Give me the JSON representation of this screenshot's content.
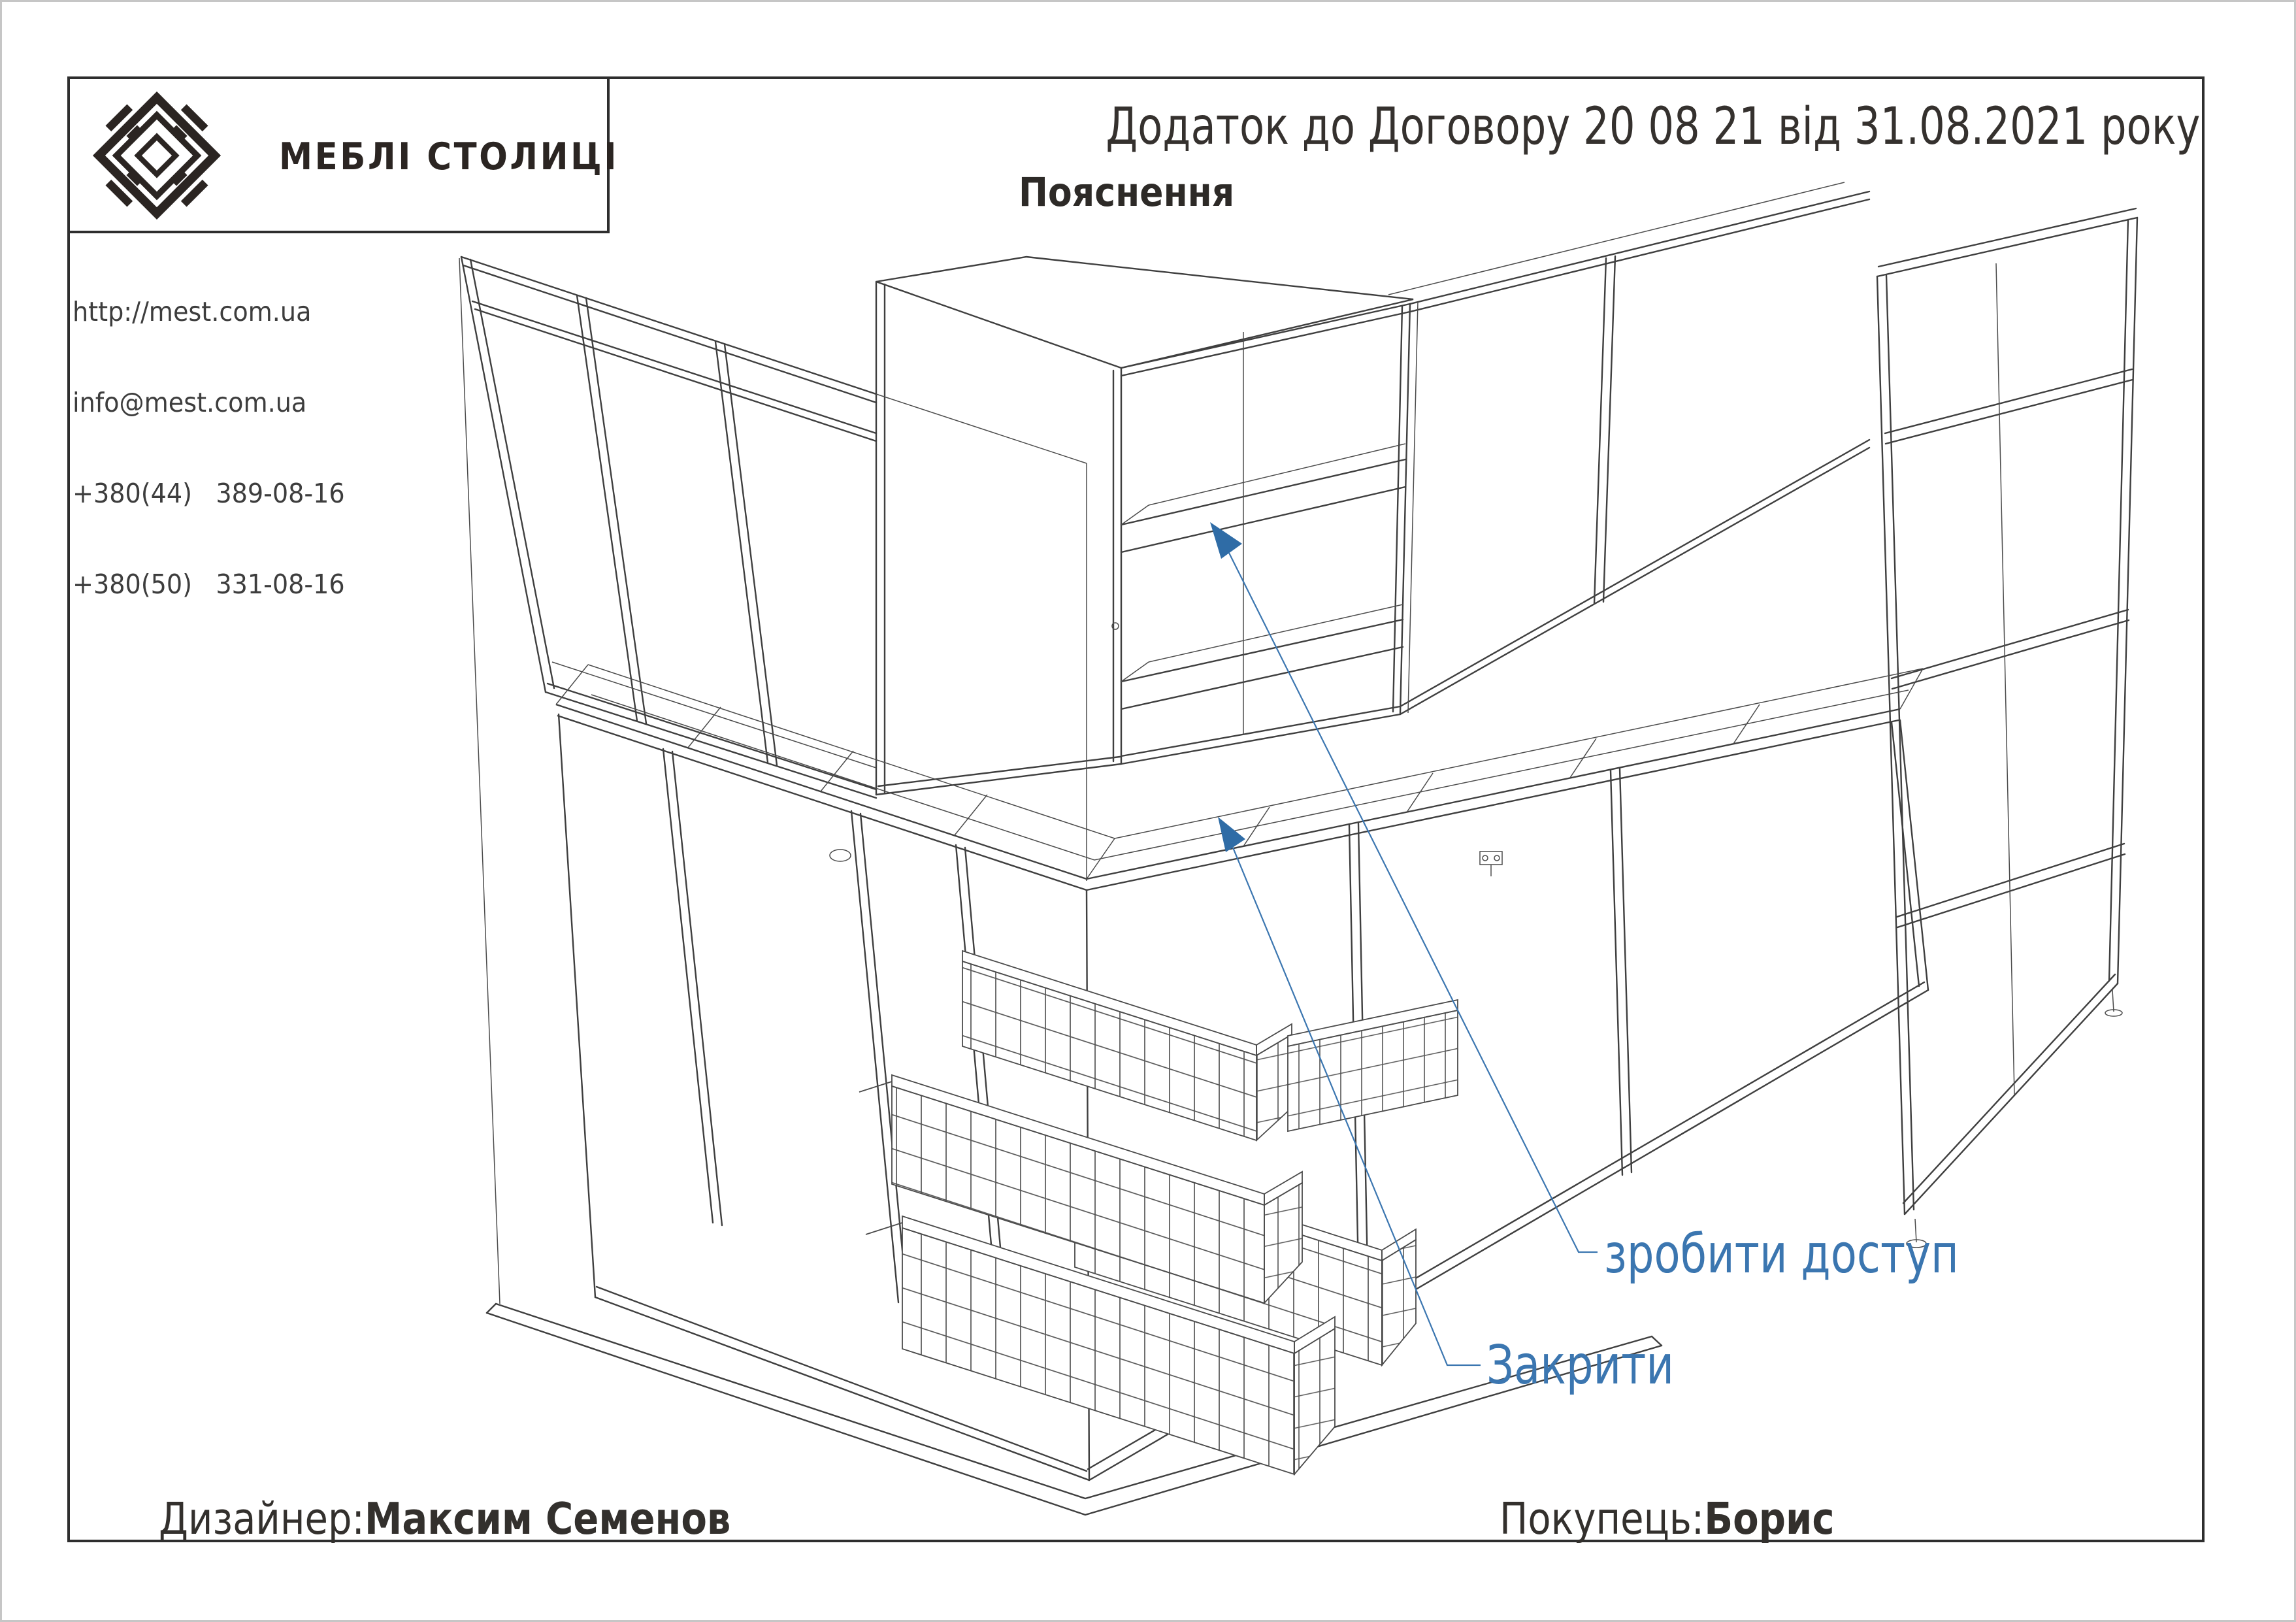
{
  "logo": {
    "brand": "МЕБЛІ СТОЛИЦІ",
    "mark": "diamond-logo"
  },
  "contacts": {
    "website": "http://mest.com.ua",
    "email": "info@mest.com.ua",
    "phone1": "+380(44)   389-08-16",
    "phone2": "+380(50)   331-08-16"
  },
  "header": {
    "title": "Додаток до Договору 20 08 21 від 31.08.2021 року",
    "subtitle": "Пояснення"
  },
  "drawing": {
    "description": "corner-kitchen-wireframe-with-wire-baskets",
    "accent_color": "#3B76B0",
    "arrow_color": "#2F6CA6",
    "line_color": "#3F3F3F",
    "annotations": [
      {
        "label": "зробити доступ"
      },
      {
        "label": "Закрити"
      }
    ]
  },
  "footer": {
    "designer_label": "Дизайнер:",
    "designer_name": "Максим Семенов",
    "customer_label": "Покупець:",
    "customer_name": "Борис"
  }
}
